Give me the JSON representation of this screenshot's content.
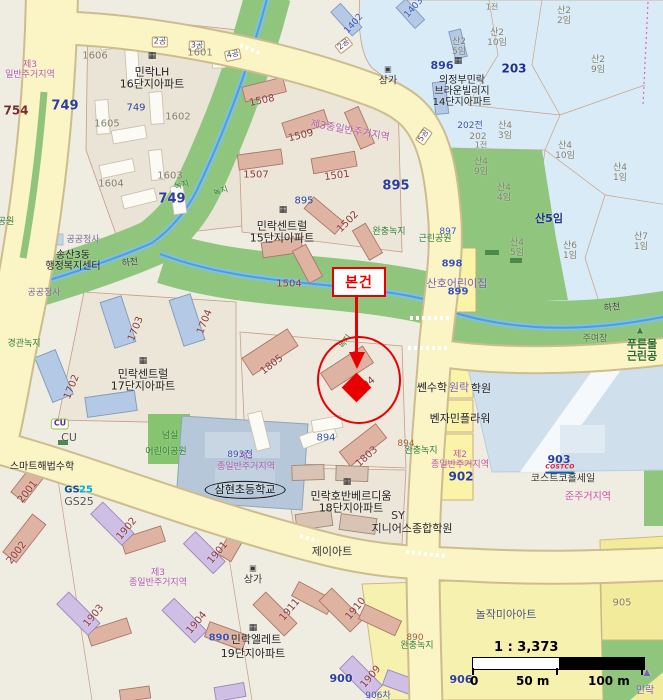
{
  "map": {
    "annotation": {
      "label": "본건"
    },
    "scale": {
      "ratio": "1 : 3,373",
      "t0": "0",
      "t50": "50 m",
      "t100": "100 m"
    },
    "labels": [
      {
        "t": "2공",
        "x": 160,
        "y": 42,
        "c": "#4a4a7a",
        "s": 8,
        "cls": "plate"
      },
      {
        "t": "3공",
        "x": 197,
        "y": 46,
        "c": "#4a4a7a",
        "s": 8,
        "cls": "plate"
      },
      {
        "t": "4공",
        "x": 233,
        "y": 55,
        "c": "#4a4a7a",
        "s": 8,
        "r": -12,
        "cls": "plate"
      },
      {
        "t": "2공",
        "x": 344,
        "y": 45,
        "c": "#4a4a7a",
        "s": 8,
        "r": -38,
        "cls": "plate"
      },
      {
        "t": "5공",
        "x": 424,
        "y": 136,
        "c": "#4a4a7a",
        "s": 8,
        "r": -55,
        "cls": "plate"
      },
      {
        "t": "1전",
        "x": 492,
        "y": 8,
        "c": "#857f6d",
        "s": 8
      },
      {
        "t": "산2\n2임",
        "x": 564,
        "y": 16,
        "c": "#857f6d",
        "s": 9
      },
      {
        "t": "산2\n10임",
        "x": 497,
        "y": 38,
        "c": "#857f6d",
        "s": 9
      },
      {
        "t": "산2\n5임",
        "x": 459,
        "y": 47,
        "c": "#857f6d",
        "s": 9
      },
      {
        "t": "산2\n9임",
        "x": 598,
        "y": 65,
        "c": "#857f6d",
        "s": 9
      },
      {
        "t": "203",
        "x": 514,
        "y": 69,
        "c": "#1f2f8f",
        "s": 12,
        "b": 1
      },
      {
        "t": "896",
        "x": 442,
        "y": 66,
        "c": "#2b3f9e",
        "s": 11,
        "b": 1
      },
      {
        "t": "의정부민락\n브라운빌리지\n14단지아파트",
        "x": 462,
        "y": 92,
        "c": "#222",
        "s": 10
      },
      {
        "t": "▦",
        "x": 458,
        "y": 61,
        "c": "#222",
        "s": 9,
        "n": "building-icon"
      },
      {
        "t": "202전",
        "x": 470,
        "y": 126,
        "c": "#3b55b5",
        "s": 9
      },
      {
        "t": "202",
        "x": 478,
        "y": 137,
        "c": "#857f6d",
        "s": 9
      },
      {
        "t": "1전",
        "x": 481,
        "y": 146,
        "c": "#857f6d",
        "s": 8
      },
      {
        "t": "산4\n3임",
        "x": 505,
        "y": 131,
        "c": "#857f6d",
        "s": 9
      },
      {
        "t": "산4\n10임",
        "x": 565,
        "y": 151,
        "c": "#857f6d",
        "s": 9
      },
      {
        "t": "산4\n9임",
        "x": 481,
        "y": 167,
        "c": "#857f6d",
        "s": 9
      },
      {
        "t": "산4\n1임",
        "x": 620,
        "y": 173,
        "c": "#857f6d",
        "s": 9
      },
      {
        "t": "산4\n4임",
        "x": 504,
        "y": 193,
        "c": "#857f6d",
        "s": 9
      },
      {
        "t": "산5임",
        "x": 549,
        "y": 219,
        "c": "#1f2f8f",
        "s": 11,
        "b": 1
      },
      {
        "t": "산7\n1임",
        "x": 641,
        "y": 242,
        "c": "#857f6d",
        "s": 9
      },
      {
        "t": "산6\n1임",
        "x": 570,
        "y": 251,
        "c": "#857f6d",
        "s": 9
      },
      {
        "t": "산4\n5임",
        "x": 517,
        "y": 248,
        "c": "#857f6d",
        "s": 9
      },
      {
        "t": "상가",
        "x": 388,
        "y": 81,
        "c": "#333",
        "s": 10
      },
      {
        "t": "▣",
        "x": 388,
        "y": 70,
        "c": "#3a3a3a",
        "s": 8,
        "n": "shop-icon"
      },
      {
        "t": "1402",
        "x": 354,
        "y": 24,
        "c": "#3b55b5",
        "s": 9,
        "r": -48
      },
      {
        "t": "1403",
        "x": 414,
        "y": 8,
        "c": "#3b55b5",
        "s": 9,
        "r": -48
      },
      {
        "t": "제3\n일반주거지역",
        "x": 30,
        "y": 70,
        "c": "#b05fb0",
        "s": 9
      },
      {
        "t": "754",
        "x": 16,
        "y": 111,
        "c": "#7a2a2a",
        "s": 12,
        "b": 1
      },
      {
        "t": "749",
        "x": 65,
        "y": 107,
        "c": "#2b3f9e",
        "s": 13,
        "b": 1
      },
      {
        "t": "749",
        "x": 136,
        "y": 108,
        "c": "#2b3f9e",
        "s": 10
      },
      {
        "t": "749",
        "x": 172,
        "y": 200,
        "c": "#2b3f9e",
        "s": 13,
        "b": 1
      },
      {
        "t": "1606",
        "x": 95,
        "y": 56,
        "c": "#857f6d",
        "s": 10
      },
      {
        "t": "민락LH\n16단지아파트",
        "x": 152,
        "y": 79,
        "c": "#222",
        "s": 11
      },
      {
        "t": "▦",
        "x": 152,
        "y": 56,
        "c": "#222",
        "s": 9,
        "n": "building-icon"
      },
      {
        "t": "1601",
        "x": 200,
        "y": 53,
        "c": "#857f6d",
        "s": 10
      },
      {
        "t": "1605",
        "x": 107,
        "y": 124,
        "c": "#857f6d",
        "s": 10
      },
      {
        "t": "1602",
        "x": 178,
        "y": 117,
        "c": "#857f6d",
        "s": 10
      },
      {
        "t": "1604",
        "x": 111,
        "y": 184,
        "c": "#857f6d",
        "s": 10
      },
      {
        "t": "1603",
        "x": 170,
        "y": 176,
        "c": "#857f6d",
        "s": 10
      },
      {
        "t": "녹지",
        "x": 182,
        "y": 186,
        "c": "#2e7d32",
        "s": 8,
        "r": -15
      },
      {
        "t": "녹지",
        "x": 221,
        "y": 192,
        "c": "#2e7d32",
        "s": 8,
        "r": -18
      },
      {
        "t": "1508",
        "x": 262,
        "y": 101,
        "c": "#8b3a3a",
        "s": 10,
        "r": -12
      },
      {
        "t": "1509",
        "x": 301,
        "y": 136,
        "c": "#8b3a3a",
        "s": 10,
        "r": -14
      },
      {
        "t": "제3종일반주거지역",
        "x": 350,
        "y": 131,
        "c": "#b05fb0",
        "s": 10,
        "r": 10
      },
      {
        "t": "1507",
        "x": 256,
        "y": 175,
        "c": "#8b3a3a",
        "s": 10
      },
      {
        "t": "1501",
        "x": 337,
        "y": 176,
        "c": "#8b3a3a",
        "s": 10,
        "r": -8
      },
      {
        "t": "895",
        "x": 396,
        "y": 187,
        "c": "#2b3f9e",
        "s": 13,
        "b": 1
      },
      {
        "t": "895",
        "x": 304,
        "y": 201,
        "c": "#2b3f9e",
        "s": 10
      },
      {
        "t": "민락센트럴\n15단지아파트",
        "x": 282,
        "y": 233,
        "c": "#222",
        "s": 11
      },
      {
        "t": "▦",
        "x": 283,
        "y": 210,
        "c": "#222",
        "s": 9,
        "n": "building-icon"
      },
      {
        "t": "1502",
        "x": 348,
        "y": 222,
        "c": "#8b3a3a",
        "s": 10,
        "r": -45
      },
      {
        "t": "완충녹지",
        "x": 389,
        "y": 232,
        "c": "#2e7d32",
        "s": 9
      },
      {
        "t": "1504",
        "x": 289,
        "y": 284,
        "c": "#8b3a3a",
        "s": 10
      },
      {
        "t": "하천",
        "x": 130,
        "y": 263,
        "c": "#444",
        "s": 9,
        "r": -8
      },
      {
        "t": "하천",
        "x": 612,
        "y": 308,
        "c": "#444",
        "s": 9,
        "r": -6
      },
      {
        "t": "공공청사",
        "x": 83,
        "y": 240,
        "c": "#7a6a9a",
        "s": 9
      },
      {
        "t": "송산3동\n행정복지센터",
        "x": 73,
        "y": 261,
        "c": "#222",
        "s": 10
      },
      {
        "t": "공공청사",
        "x": 44,
        "y": 293,
        "c": "#7a6a9a",
        "s": 9
      },
      {
        "t": "경관녹지",
        "x": 24,
        "y": 344,
        "c": "#2e7d32",
        "s": 9
      },
      {
        "t": "공원",
        "x": 6,
        "y": 222,
        "c": "#2e7d32",
        "s": 9
      },
      {
        "t": "1703",
        "x": 136,
        "y": 329,
        "c": "#8b3a3a",
        "s": 10,
        "r": -68
      },
      {
        "t": "1704",
        "x": 205,
        "y": 322,
        "c": "#8b3a3a",
        "s": 10,
        "r": -68
      },
      {
        "t": "1702",
        "x": 72,
        "y": 387,
        "c": "#8b3a3a",
        "s": 10,
        "r": -68
      },
      {
        "t": "민락센트럴\n17단지아파트",
        "x": 143,
        "y": 381,
        "c": "#222",
        "s": 11
      },
      {
        "t": "▦",
        "x": 143,
        "y": 361,
        "c": "#222",
        "s": 9,
        "n": "building-icon"
      },
      {
        "t": "1805",
        "x": 272,
        "y": 365,
        "c": "#8b3a3a",
        "s": 10,
        "r": -38
      },
      {
        "t": "1804",
        "x": 364,
        "y": 387,
        "c": "#8b3a3a",
        "s": 10,
        "r": -38
      },
      {
        "t": "녹지",
        "x": 346,
        "y": 342,
        "c": "#2e7d32",
        "s": 8,
        "r": -55
      },
      {
        "t": "근린공원",
        "x": 435,
        "y": 239,
        "c": "#2e7d32",
        "s": 9
      },
      {
        "t": "897",
        "x": 448,
        "y": 232,
        "c": "#3b55b5",
        "s": 9
      },
      {
        "t": "898",
        "x": 452,
        "y": 264,
        "c": "#3b55b5",
        "s": 10,
        "b": 1
      },
      {
        "t": "산호어린이집",
        "x": 457,
        "y": 284,
        "c": "#7a5fb5",
        "s": 11
      },
      {
        "t": "899",
        "x": 458,
        "y": 292,
        "c": "#3b55b5",
        "s": 10,
        "b": 1
      },
      {
        "t": "주여창",
        "x": 595,
        "y": 339,
        "c": "#5a6b4a",
        "s": 9
      },
      {
        "t": "▲",
        "x": 640,
        "y": 331,
        "c": "#3e7a3e",
        "s": 8,
        "n": "tree-icon"
      },
      {
        "t": "푸른물\n근린공",
        "x": 642,
        "y": 351,
        "c": "#2e6b2e",
        "s": 11,
        "b": 1
      },
      {
        "t": "쎈수학",
        "x": 432,
        "y": 388,
        "c": "#222",
        "s": 11
      },
      {
        "t": "원락",
        "x": 459,
        "y": 388,
        "c": "#7a5fb5",
        "s": 11
      },
      {
        "t": "학원",
        "x": 481,
        "y": 389,
        "c": "#222",
        "s": 11
      },
      {
        "t": "벤자민플라워",
        "x": 460,
        "y": 419,
        "c": "#222",
        "s": 11
      },
      {
        "t": "제2\n종일반주거지역",
        "x": 460,
        "y": 460,
        "c": "#c0569e",
        "s": 9
      },
      {
        "t": "902",
        "x": 461,
        "y": 477,
        "c": "#2b3f9e",
        "s": 12,
        "b": 1
      },
      {
        "t": "894",
        "x": 326,
        "y": 438,
        "c": "#3b55b5",
        "s": 10
      },
      {
        "t": "894",
        "x": 406,
        "y": 444,
        "c": "#a0622d",
        "s": 9
      },
      {
        "t": "완충녹지",
        "x": 421,
        "y": 451,
        "c": "#2e7d32",
        "s": 9
      },
      {
        "t": "1803",
        "x": 367,
        "y": 457,
        "c": "#8b3a3a",
        "s": 10,
        "r": -42
      },
      {
        "t": "민락호반베르디움\n18단지아파트",
        "x": 351,
        "y": 503,
        "c": "#222",
        "s": 11
      },
      {
        "t": "▦",
        "x": 347,
        "y": 482,
        "c": "#222",
        "s": 9,
        "n": "building-icon"
      },
      {
        "t": "제이아트",
        "x": 332,
        "y": 552,
        "c": "#333",
        "s": 11
      },
      {
        "t": "SY",
        "x": 398,
        "y": 516,
        "c": "#333",
        "s": 11
      },
      {
        "t": "지니어스종합학원",
        "x": 412,
        "y": 529,
        "c": "#222",
        "s": 11
      },
      {
        "t": "903",
        "x": 559,
        "y": 460,
        "c": "#2b3f9e",
        "s": 11,
        "b": 1
      },
      {
        "t": "COSTCO",
        "x": 560,
        "y": 469,
        "c": "#e31837",
        "s": 6,
        "b": 1,
        "cls": "costco",
        "n": "costco-logo"
      },
      {
        "t": "코스트코홀세일",
        "x": 563,
        "y": 479,
        "c": "#333",
        "s": 10
      },
      {
        "t": "준주거지역",
        "x": 588,
        "y": 497,
        "c": "#cc4fa0",
        "s": 10
      },
      {
        "t": "CU",
        "x": 60,
        "y": 424,
        "c": "#5c2d91",
        "s": 8,
        "b": 1,
        "cls": "cu",
        "n": "cu-logo"
      },
      {
        "t": "CU",
        "x": 69,
        "y": 438,
        "c": "#555",
        "s": 11
      },
      {
        "t": "스마트해법수학",
        "x": 42,
        "y": 467,
        "c": "#222",
        "s": 10
      },
      {
        "t": "GS",
        "x": 72,
        "y": 490,
        "c": "#0e4c96",
        "s": 10,
        "b": 1,
        "n": "gs25-logo"
      },
      {
        "t": "25",
        "x": 86,
        "y": 490,
        "c": "#00b0e0",
        "s": 10,
        "b": 1,
        "n": "gs25-logo"
      },
      {
        "t": "GS25",
        "x": 79,
        "y": 502,
        "c": "#555",
        "s": 11
      },
      {
        "t": "2001",
        "x": 28,
        "y": 492,
        "c": "#8b3a3a",
        "s": 10,
        "r": -52
      },
      {
        "t": "2002",
        "x": 17,
        "y": 553,
        "c": "#8b3a3a",
        "s": 10,
        "r": -52
      },
      {
        "t": "넘실",
        "x": 170,
        "y": 436,
        "c": "#2e7d32",
        "s": 9
      },
      {
        "t": "어린이공원",
        "x": 166,
        "y": 452,
        "c": "#2e7d32",
        "s": 9
      },
      {
        "t": "제3\n종일반주거지역",
        "x": 246,
        "y": 462,
        "c": "#b05fb0",
        "s": 9
      },
      {
        "t": "893전",
        "x": 240,
        "y": 455,
        "c": "#3b55b5",
        "s": 9
      },
      {
        "t": "삼현초등학교",
        "x": 245,
        "y": 490,
        "c": "#111",
        "s": 11,
        "cls": "ellipse",
        "n": "school-label"
      },
      {
        "t": "1902",
        "x": 127,
        "y": 529,
        "c": "#8b3a3a",
        "s": 10,
        "r": -50
      },
      {
        "t": "1901",
        "x": 218,
        "y": 553,
        "c": "#8b3a3a",
        "s": 10,
        "r": -50
      },
      {
        "t": "상가",
        "x": 253,
        "y": 580,
        "c": "#333",
        "s": 10
      },
      {
        "t": "▣",
        "x": 253,
        "y": 569,
        "c": "#3a3a3a",
        "s": 8,
        "n": "shop-icon"
      },
      {
        "t": "제3\n종일반주거지역",
        "x": 158,
        "y": 578,
        "c": "#b05fb0",
        "s": 9
      },
      {
        "t": "1903",
        "x": 94,
        "y": 616,
        "c": "#8b3a3a",
        "s": 10,
        "r": -50
      },
      {
        "t": "1904",
        "x": 197,
        "y": 623,
        "c": "#8b3a3a",
        "s": 10,
        "r": -50
      },
      {
        "t": "890",
        "x": 219,
        "y": 638,
        "c": "#3b55b5",
        "s": 10,
        "b": 1
      },
      {
        "t": "민락엘레트",
        "x": 256,
        "y": 640,
        "c": "#222",
        "s": 11
      },
      {
        "t": "19단지아파트",
        "x": 253,
        "y": 654,
        "c": "#222",
        "s": 11
      },
      {
        "t": "▦",
        "x": 253,
        "y": 628,
        "c": "#222",
        "s": 9,
        "n": "building-icon"
      },
      {
        "t": "1911",
        "x": 290,
        "y": 610,
        "c": "#8b3a3a",
        "s": 10,
        "r": -50
      },
      {
        "t": "1910",
        "x": 356,
        "y": 609,
        "c": "#8b3a3a",
        "s": 10,
        "r": -50
      },
      {
        "t": "1909",
        "x": 371,
        "y": 677,
        "c": "#8b3a3a",
        "s": 10,
        "r": -50
      },
      {
        "t": "890",
        "x": 415,
        "y": 638,
        "c": "#a0622d",
        "s": 9
      },
      {
        "t": "완충녹지",
        "x": 417,
        "y": 646,
        "c": "#2e7d32",
        "s": 9
      },
      {
        "t": "906",
        "x": 461,
        "y": 680,
        "c": "#2b3f9e",
        "s": 11,
        "b": 1
      },
      {
        "t": "900",
        "x": 341,
        "y": 679,
        "c": "#2b3f9e",
        "s": 11,
        "b": 1
      },
      {
        "t": "906차",
        "x": 378,
        "y": 696,
        "c": "#3b55b5",
        "s": 9
      },
      {
        "t": "905",
        "x": 622,
        "y": 603,
        "c": "#857f6d",
        "s": 10
      },
      {
        "t": "놀작미아아트",
        "x": 506,
        "y": 615,
        "c": "#4a5568",
        "s": 11
      },
      {
        "t": "민락",
        "x": 645,
        "y": 691,
        "c": "#7a5fb5",
        "s": 10
      },
      {
        "t": "▲",
        "x": 647,
        "y": 673,
        "c": "#7a5fb5",
        "s": 9,
        "n": "arrow-icon"
      }
    ]
  }
}
